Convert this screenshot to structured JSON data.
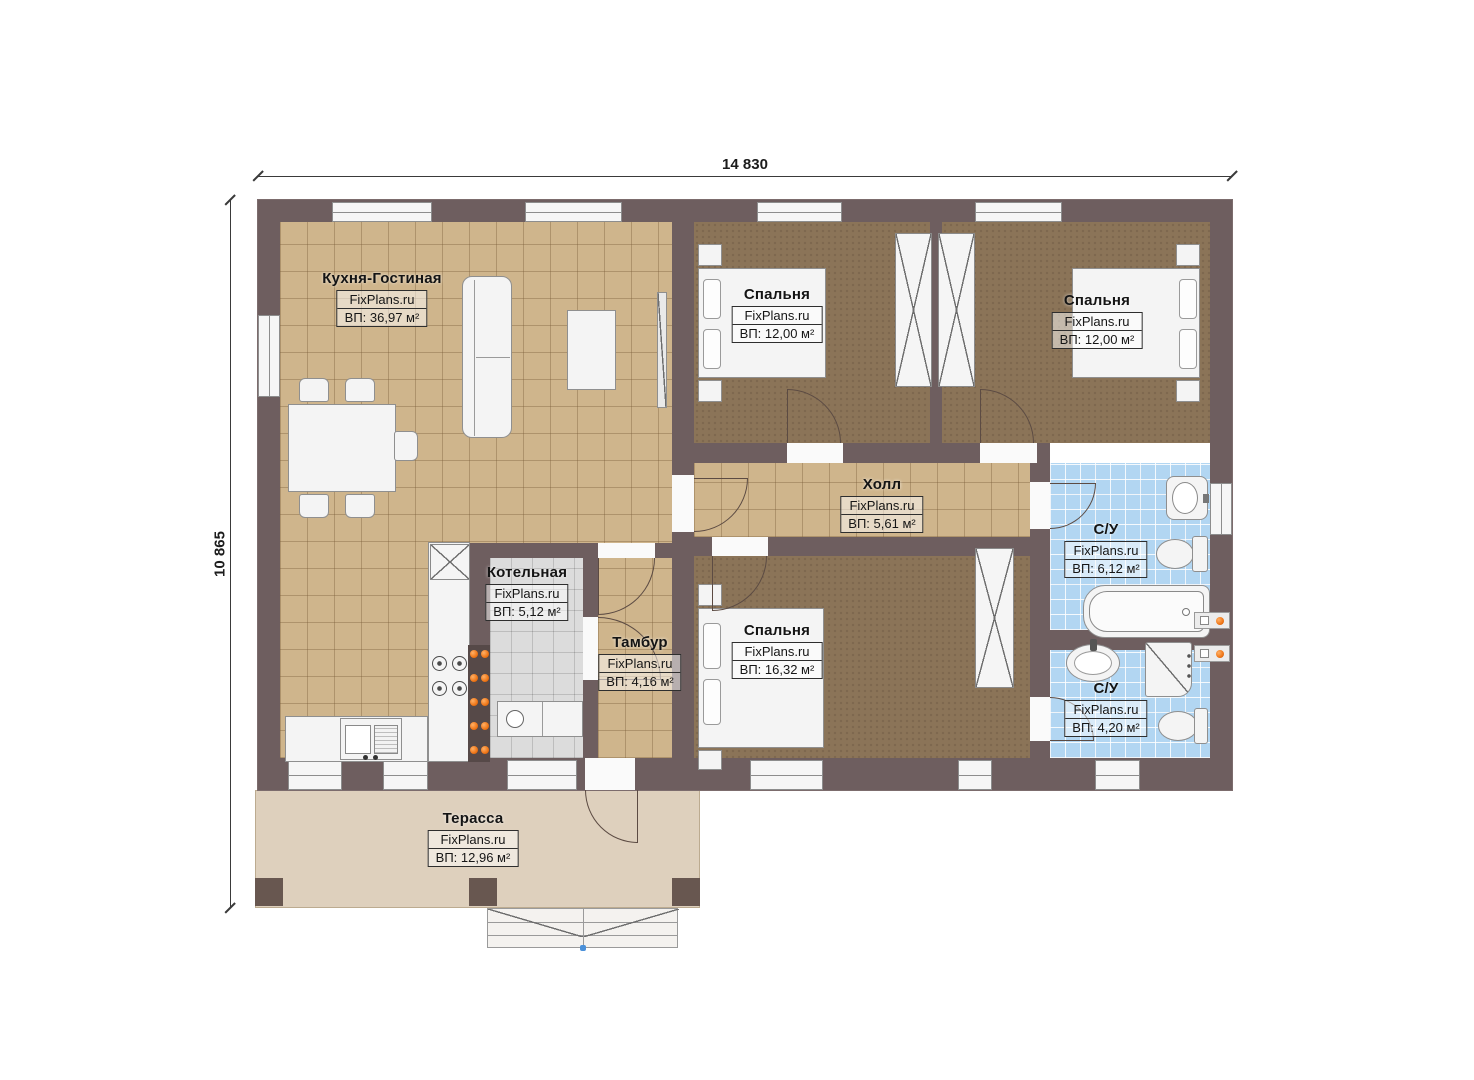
{
  "brand": "FixPlans.ru",
  "dimensions": {
    "width": "14 830",
    "height": "10 865"
  },
  "rooms": [
    {
      "name": "Кухня-Гостиная",
      "brand": "FixPlans.ru",
      "area": "ВП: 36,97 м²"
    },
    {
      "name": "Спальня",
      "brand": "FixPlans.ru",
      "area": "ВП: 12,00 м²"
    },
    {
      "name": "Спальня",
      "brand": "FixPlans.ru",
      "area": "ВП: 12,00 м²"
    },
    {
      "name": "Холл",
      "brand": "FixPlans.ru",
      "area": "ВП: 5,61 м²"
    },
    {
      "name": "Котельная",
      "brand": "FixPlans.ru",
      "area": "ВП: 5,12 м²"
    },
    {
      "name": "Тамбур",
      "brand": "FixPlans.ru",
      "area": "ВП: 4,16 м²"
    },
    {
      "name": "Спальня",
      "brand": "FixPlans.ru",
      "area": "ВП: 16,32 м²"
    },
    {
      "name": "С/У",
      "brand": "FixPlans.ru",
      "area": "ВП: 6,12 м²"
    },
    {
      "name": "С/У",
      "brand": "FixPlans.ru",
      "area": "ВП: 4,20 м²"
    },
    {
      "name": "Терасса",
      "brand": "FixPlans.ru",
      "area": "ВП: 12,96 м²"
    }
  ],
  "colors": {
    "wall": "#6e5e5f",
    "kitchen_floor": "#cfb58c",
    "bedroom_floor": "#8b7458",
    "bath_floor": "#b2d6f2",
    "boiler_floor": "#dcdcdc",
    "terrace_floor": "#ded0bd",
    "radiator_accent": "#ef7617"
  }
}
